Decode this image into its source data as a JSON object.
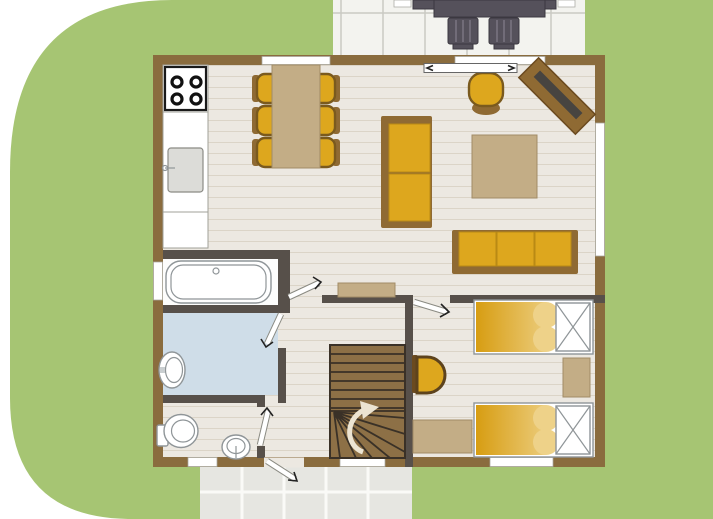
{
  "meta": {
    "type": "floor-plan",
    "view": "top-down ground floor of a holiday home with lawn and two tiled terraces",
    "visible_text": ""
  },
  "colors": {
    "page": "#ffffff",
    "grass": "#a6c573",
    "wall": "#8a6c3e",
    "wallInner": "#57504a",
    "floor": "#ece8e1",
    "plank": "#dbd4c7",
    "terraceTile": "#f3f3ef",
    "terraceGrout": "#c9c9c3",
    "pathTile": "#e6e6e1",
    "pathGrout": "#fafaf7",
    "furnYellow": "#dda71e",
    "furnYellowLight": "#eed289",
    "furnBrown": "#8f6a33",
    "furnTan": "#c3ad86",
    "bathFloor": "#cfdde8",
    "fixture": "#ffffff",
    "fixtureLine": "#8f9598",
    "outdoor": "#55515b",
    "stair": "#8d7046",
    "stairLine": "#3a3127",
    "screen": "#474440",
    "arrow": "#ece4d2",
    "doorLine": "#222222"
  },
  "inventory": {
    "dining_chairs": 6,
    "sofas": 2,
    "armchairs": 2,
    "beds": 2,
    "patio_chairs": 2,
    "interior_doors": 4,
    "exterior_doors": 2,
    "windows": 6,
    "stair_flights": 1
  }
}
